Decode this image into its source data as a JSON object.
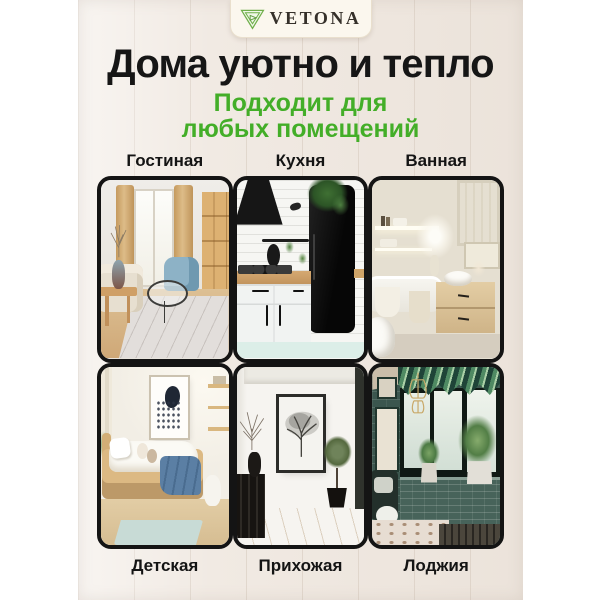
{
  "brand": {
    "name": "VETONA",
    "logo_icon": "nested-triangle-leaf-logo"
  },
  "headline": "Дома уютно и тепло",
  "subtitle": {
    "line1": "Подходит для",
    "line2": "любых помещений"
  },
  "rooms": [
    {
      "label": "Гостиная"
    },
    {
      "label": "Кухня"
    },
    {
      "label": "Ванная"
    },
    {
      "label": "Детская"
    },
    {
      "label": "Прихожая"
    },
    {
      "label": "Лоджия"
    }
  ],
  "colors": {
    "accent_green": "#43ae28",
    "headline_text": "#161616",
    "tile_border": "#141414",
    "panel_wood": "#f1eae3",
    "badge_background": "#fbf7ee",
    "logo_green": "#6fae4a"
  }
}
